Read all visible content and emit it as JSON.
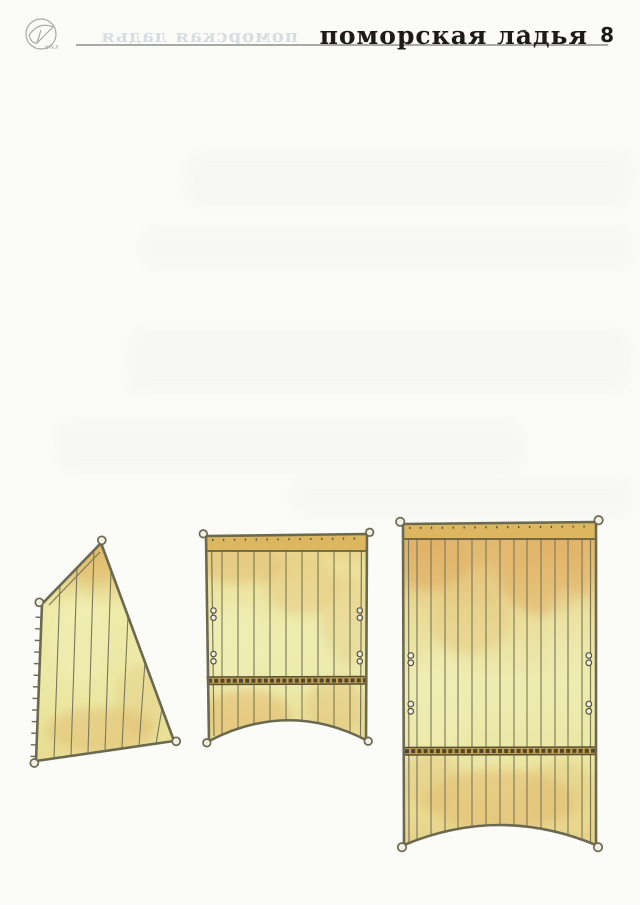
{
  "header": {
    "title": "поморская ладья",
    "page_number": "8",
    "logo_text": "ОРЕЛ",
    "ghost_title": "поморская ладья"
  },
  "plate": {
    "description": "sail cutting patterns for the pomor lodya paper model",
    "pieces": [
      {
        "name": "triangular fore sail",
        "panels": 8,
        "corner_rings": 4,
        "laced_edge_ticks": 13
      },
      {
        "name": "medium square sail",
        "panels": 10,
        "corner_rings": 4,
        "eyelet_pairs": 4,
        "reef_bands": 1
      },
      {
        "name": "large main sail",
        "panels": 14,
        "corner_rings": 4,
        "eyelet_pairs": 4,
        "reef_bands": 1
      }
    ]
  },
  "colors": {
    "page_bg": "#fbfbf8",
    "rule": "#a9a9a5",
    "title_ink": "#1d1b1a",
    "ghost_ink": "rgba(168,178,192,0.42)",
    "outline": "#6b6950",
    "seam": "#7a775c",
    "head_band": "#dcb760",
    "band_dark": "#55513a",
    "reef_bg": "#c8a045",
    "reef_link": "#4c4733",
    "ring_fill": "#f1efe6",
    "sail_tan": "#e2bc72",
    "sail_orange": "#e0ad62",
    "sail_pale": "#eff0b8"
  }
}
